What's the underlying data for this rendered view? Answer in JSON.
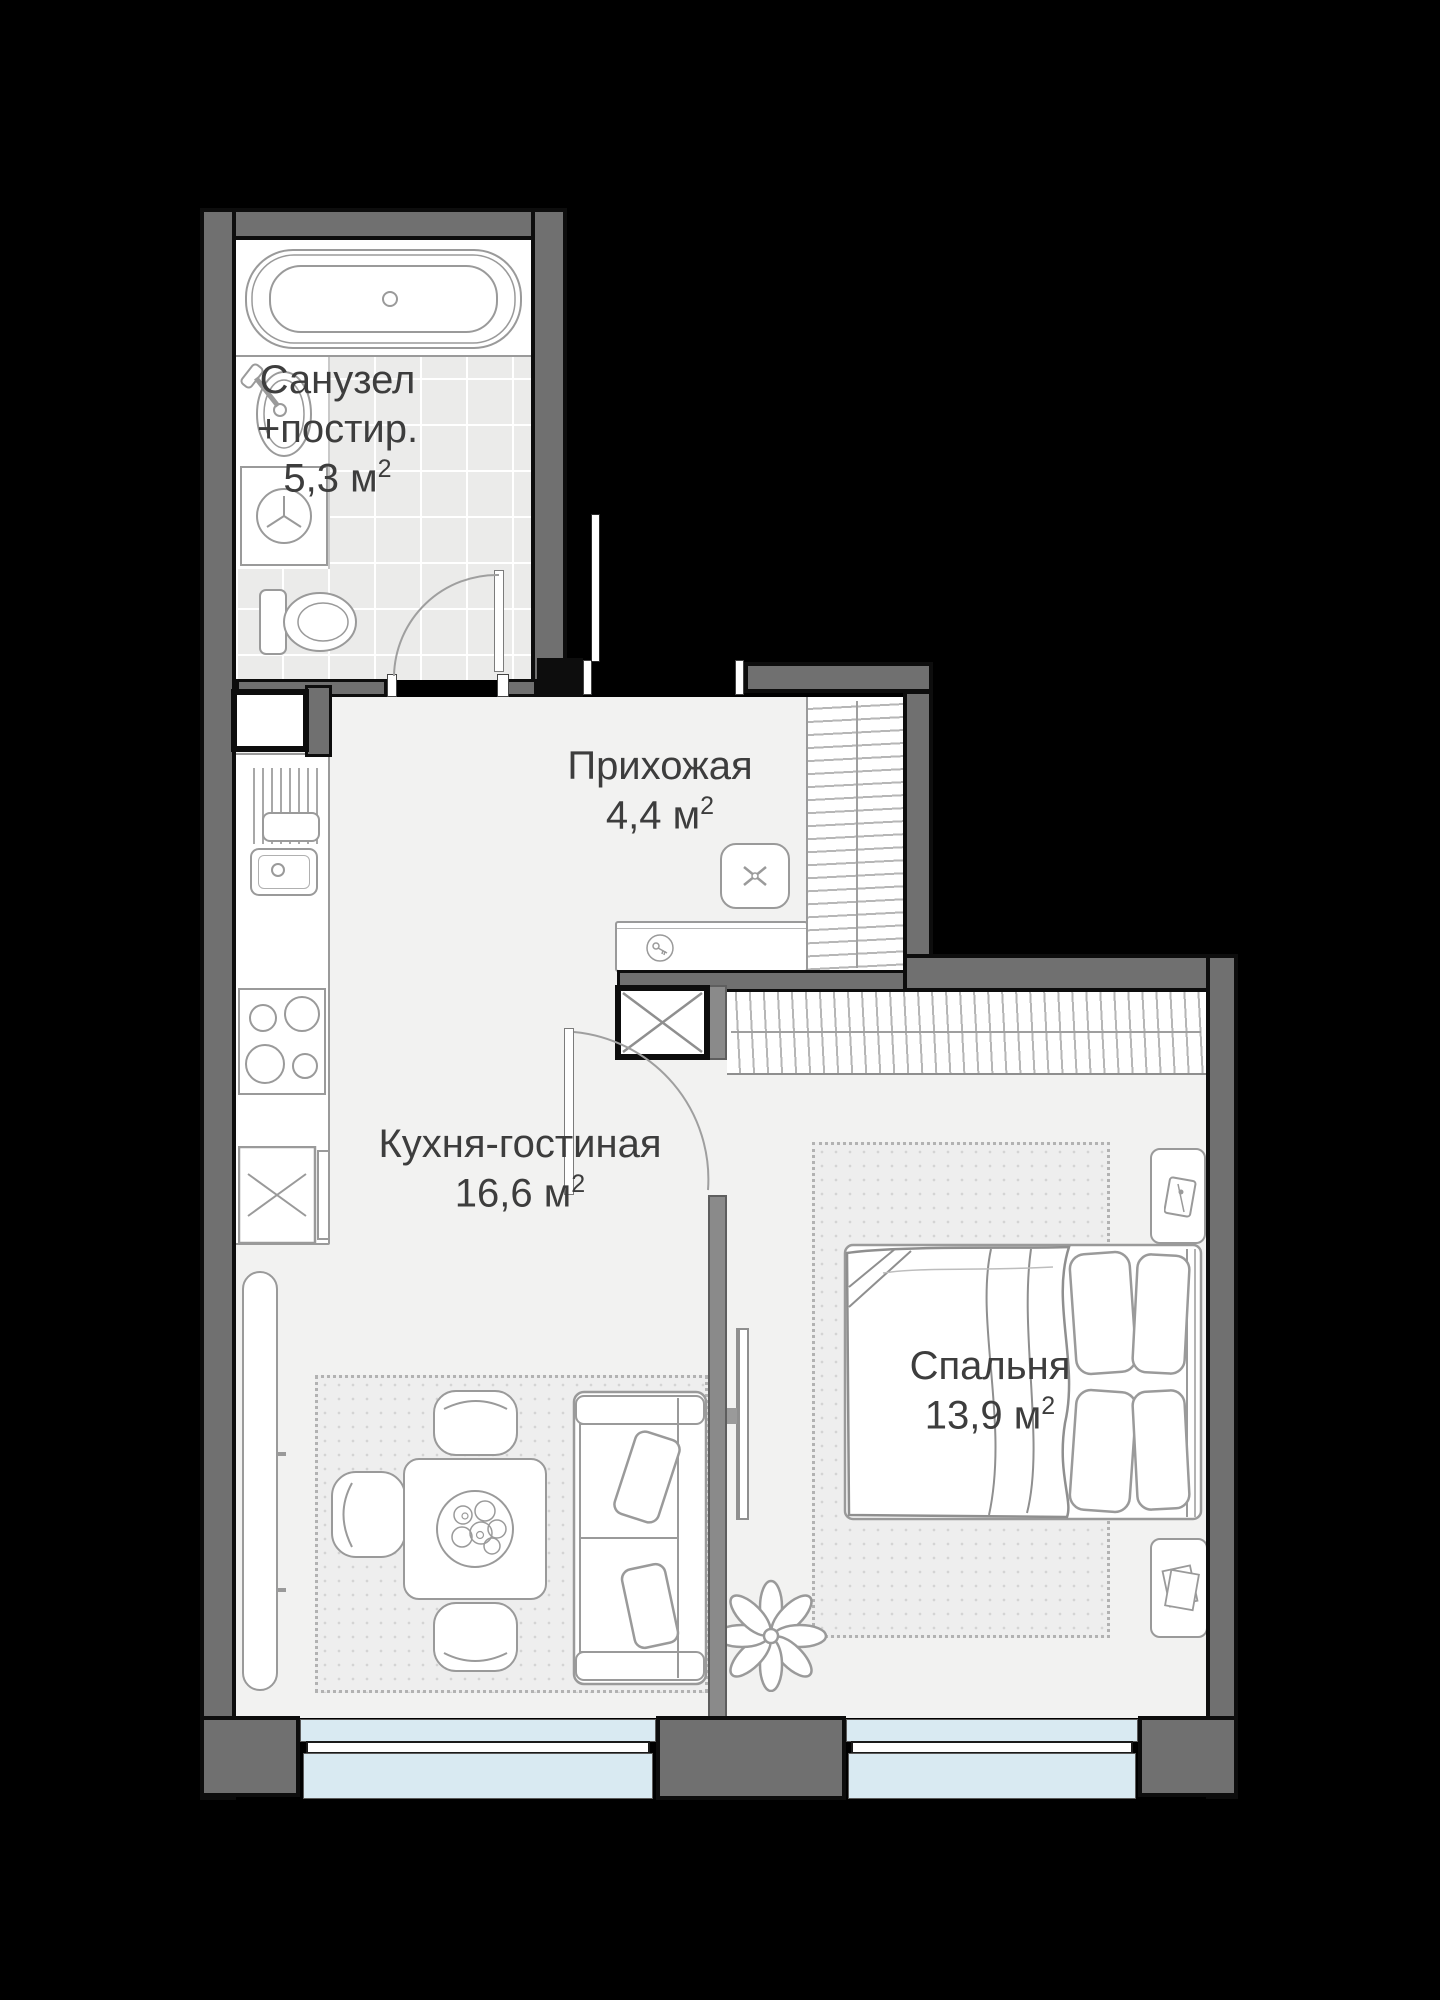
{
  "plan": {
    "unit": "м",
    "unit_exp": "2",
    "rooms": {
      "bathroom": {
        "name": "Санузел",
        "name_suffix": "+постир.",
        "area": "5,3"
      },
      "hallway": {
        "name": "Прихожая",
        "area": "4,4"
      },
      "kitchen_living": {
        "name": "Кухня-гостиная",
        "area": "16,6"
      },
      "bedroom": {
        "name": "Спальня",
        "area": "13,9"
      }
    },
    "colors": {
      "outside": "#000000",
      "exterior_wall": "#707070",
      "interior_wall": "#8a8a8a",
      "floor": "#f2f2f1",
      "bathroom_tile": "#ebebea",
      "window_glass": "#d9eaf2",
      "furniture_line": "#9a9a9a",
      "label_text": "#3d3d3d"
    },
    "fixtures": [
      "bathtub",
      "sink",
      "washing-machine",
      "toilet",
      "ventilation-shaft",
      "kitchen-counter",
      "stove",
      "fridge",
      "radiator",
      "wardrobe",
      "pouf",
      "console",
      "dining-table",
      "chair",
      "sofa",
      "plant",
      "tv",
      "bed",
      "nightstand",
      "window",
      "door"
    ]
  }
}
